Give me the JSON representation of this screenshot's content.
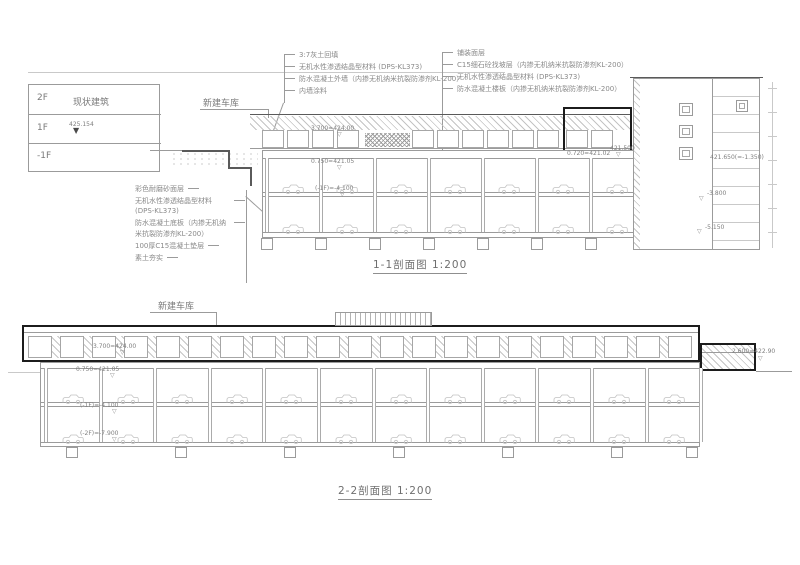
{
  "colors": {
    "line": "#9b9b9b",
    "dark_line": "#1c1c1c",
    "text": "#8a8a8a",
    "background": "#ffffff"
  },
  "legend": {
    "building_label": "现状建筑",
    "floors": [
      "2F",
      "1F",
      "-1F"
    ],
    "elevation": "425.154"
  },
  "section1": {
    "garage_label": "新建车库",
    "mid_annotations": [
      "3:7灰土回填",
      "无机水性渗透结晶型材料 (DPS-KL373)",
      "防水混凝土外墙（内掺无机纳米抗裂防渗剂KL-200）",
      "内墙涂料"
    ],
    "right_annotations": [
      "铺装面层",
      "C15细石砼找坡层（内掺无机纳米抗裂防渗剂KL-200）",
      "无机水性渗透结晶型材料 (DPS-KL373)",
      "防水混凝土楼板（内掺无机纳米抗裂防渗剂KL-200）"
    ],
    "left_annotations": [
      "彩色耐磨砂面层",
      "无机水性渗透结晶型材料 (DPS-KL373)",
      "防水混凝土底板（内掺无机纳米抗裂防渗剂KL-200）",
      "100厚C15混凝土垫层",
      "素土夯实"
    ],
    "labels": {
      "roof": "3.700=424.00",
      "ground": "0.750=421.05",
      "b1": "(-1F)=-4.100",
      "box": "0.720=421.02",
      "marker": "421.500",
      "existing": "421.650(=-1.350)",
      "lv1": "-3.800",
      "lv2": "-5.150"
    },
    "title": "1-1剖面图 1:200"
  },
  "section2": {
    "garage_label": "新建车库",
    "labels": {
      "roof": "3.700=424.00",
      "ground": "0.750=421.05",
      "b1": "(-1F)=-4.100",
      "b2": "(-2F)=-7.900",
      "right": "2.600=422.90"
    },
    "title": "2-2剖面图 1:200"
  }
}
